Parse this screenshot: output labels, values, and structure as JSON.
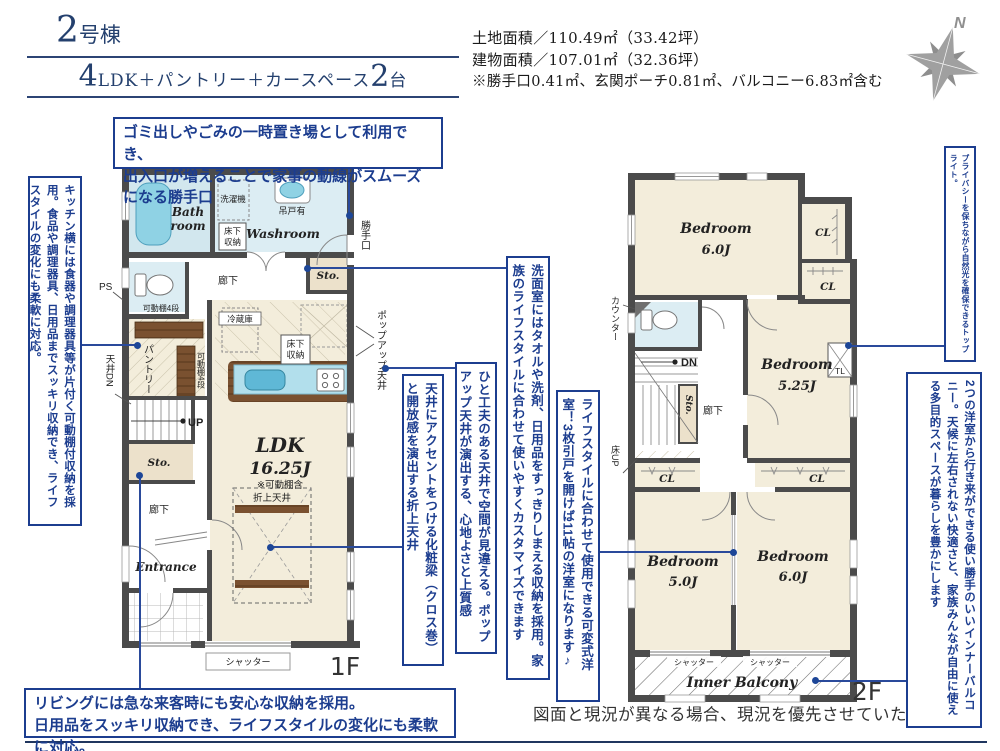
{
  "header": {
    "unit_number": "2",
    "unit_suffix": "号棟",
    "plan_num1": "4",
    "plan_mid": "LDK＋パントリー＋カースペース",
    "plan_num2": "2",
    "plan_tail": "台",
    "land_area": "土地面積／110.49㎡（33.42坪）",
    "building_area": "建物面積／107.01㎡（32.36坪）",
    "area_note": "※勝手口0.41㎡、玄関ポーチ0.81㎡、バルコニー6.83㎡含む",
    "compass_n": "N"
  },
  "notes": {
    "katteguchi": "ゴミ出しやごみの一時置き場として利用でき、\n出入口が増えることで家事の動線がスムーズになる勝手口",
    "kitchen": "キッチン横には食器や調理器具等が片付く可動棚付収納を採用。食品や調理器具、日用品までスッキリ収納でき、ライフスタイルの変化にも柔軟に対応。",
    "washroom": "洗面室にはタオルや洗剤、日用品をすっきりしまえる収納を採用。家族のライフスタイルに合わせて使いやすくカスタマイズできます",
    "popup_ceiling": "ひと工夫のある天井で空間が見違える。ポップアップ天井が演出する、心地よさと上質感",
    "beam": "天井にアクセントをつける化粧梁（クロス巻）と開放感を演出する折上天井",
    "flex_room": "ライフスタイルに合わせて使用できる可変式洋室！3枚引戸を開けば11帖の洋室になります♪",
    "toplight": "プライバシーを保ちながら自然光を確保できるトップライト。",
    "balcony": "2つの洋室から行き来ができる使い勝手のいいインナーバルコニー。天候に左右されない快適さと、家族みんなが自由に使える多目的スペースが暮らしを豊かにします",
    "living": "リビングには急な来客時にも安心な収納を採用。\n日用品をスッキリ収納でき、ライフスタイルの変化にも柔軟に対応。",
    "disclaimer": "図面と現況が異なる場合、現況を優先させていただきます。"
  },
  "floor1": {
    "floor_label": "1F",
    "rooms": {
      "bath_l1": "Bath",
      "bath_l2": "room",
      "washroom": "Washroom",
      "sto_top": "Sto.",
      "hall1": "廊下",
      "pantry": "パントリー",
      "sto_left": "Sto.",
      "hall2": "廊下",
      "entrance": "Entrance",
      "ldk": "LDK",
      "ldk_size": "16.25J",
      "ldk_note": "※可動棚含"
    },
    "labels": {
      "washer": "洗濯機",
      "hang_cabinet": "吊戸有",
      "underfloor1a": "床下",
      "underfloor1b": "収納",
      "underfloor2a": "床下",
      "underfloor2b": "収納",
      "katteguchi": "勝手口",
      "ps": "PS",
      "shelf1": "可動棚4段",
      "shelf2": "可動棚4段",
      "ceiling_dn": "天井DN",
      "fridge": "冷蔵庫",
      "popup": "ポップアップ天井",
      "up": "UP",
      "oriage": "折上天井",
      "shutter": "シャッター"
    }
  },
  "floor2": {
    "floor_label": "2F",
    "rooms": {
      "br1_name": "Bedroom",
      "br1_size": "6.0J",
      "br2_name": "Bedroom",
      "br2_size": "5.25J",
      "br3_name": "Bedroom",
      "br3_size": "5.0J",
      "br4_name": "Bedroom",
      "br4_size": "6.0J",
      "hall": "廊下",
      "sto": "Sto.",
      "balcony": "Inner Balcony"
    },
    "labels": {
      "cl1": "CL",
      "cl2": "CL",
      "cl3": "CL",
      "cl4": "CL",
      "counter": "カウンター",
      "dn": "DN",
      "tl": "TL",
      "yuka_up": "床UP",
      "shutter1": "シャッター",
      "shutter2": "シャッター"
    }
  },
  "colors": {
    "accent_blue": "#1c3d8f",
    "navy_title": "#24406e",
    "wall": "#4b4b4b",
    "room_cream": "#f3eddb",
    "wet_blue": "#dcedf3",
    "storage_beige": "#ece1cb",
    "fixture_blue": "#8fd2e4"
  }
}
